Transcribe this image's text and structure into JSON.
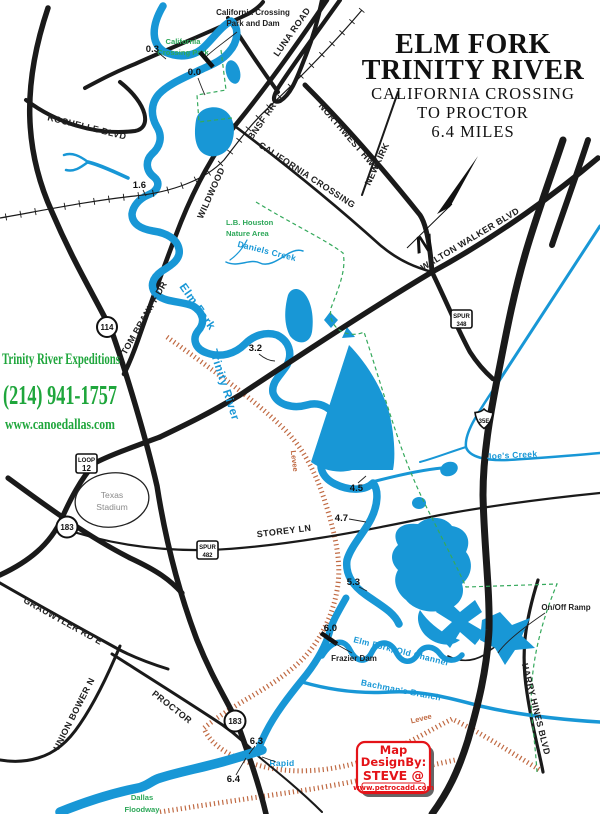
{
  "title": {
    "line1": "ELM FORK",
    "line2": "TRINITY RIVER",
    "line3": "CALIFORNIA CROSSING",
    "line4": "TO PROCTOR",
    "line5": "6.4 MILES"
  },
  "compass_n": "N",
  "advertiser": {
    "name": "Trinity River Expeditions",
    "phone": "(214) 941-1757",
    "website": "www.canoedallas.com",
    "color": "#1FA63C"
  },
  "credit": {
    "line1": "Map",
    "line2": "DesignBy:",
    "line3": "STEVE @",
    "line4": "www.petrocadd.com",
    "color": "#E41318"
  },
  "road_labels": {
    "rochelle": "ROCHELLE BLVD",
    "luna": "LUNA ROAD",
    "northwest": "NORTHWEST HWY",
    "newkirk": "NEWKIRK",
    "california_crossing": "CALIFORNIA CROSSING",
    "wildwood": "WILDWOOD",
    "tom_braniff": "TOM BRANIFF DR",
    "walton_walker": "WALTON WALKER BLVD",
    "storey": "STOREY LN",
    "grauwyler": "GRAUWYLER RD E",
    "union_bower": "UNION BOWER N",
    "proctor": "PROCTOR",
    "harry_hines": "HARRY HINES BLVD"
  },
  "rail_label": "BNSF RR",
  "shields": {
    "hwy114": "114",
    "hwy183": "183",
    "loop12": [
      "LOOP",
      "12"
    ],
    "spur348": [
      "SPUR",
      "348"
    ],
    "spur482": [
      "SPUR",
      "482"
    ],
    "i35e": "35E"
  },
  "water_labels": {
    "elm_fork_1": "Elm Fork",
    "elm_fork_2": "Trinity River",
    "daniels": "Daniels Creek",
    "joes": "Joe's Creek",
    "old_channel": "Elm Fork, Old Channel",
    "bachmans": "Bachman's Branch",
    "rapid": "Rapid"
  },
  "area_labels": {
    "park_1": "California",
    "park_2": "Crossing Park",
    "lb_1": "L.B. Houston",
    "lb_2": "Nature Area",
    "stadium_1": "Texas",
    "stadium_2": "Stadium",
    "floodway_1": "Dallas",
    "floodway_2": "Floodway"
  },
  "levee_labels": {
    "left": "Levee",
    "bottom": "Levee"
  },
  "poi_labels": {
    "park_dam_1": "California Crossing",
    "park_dam_2": "Park and Dam",
    "frazier_dam": "Frazier Dam",
    "on_off_ramp": "On/Off Ramp"
  },
  "mile_markers": [
    "0.3",
    "0.0",
    "1.6",
    "3.2",
    "4.5",
    "4.7",
    "5.3",
    "6.0",
    "6.3",
    "6.4"
  ],
  "colors": {
    "water": "#1897D6",
    "park_green": "#2EA85A",
    "boundary_green": "#35A95C",
    "levee_orange": "#C06A43",
    "credit_red": "#E41318",
    "ad_green": "#1FA63C",
    "road_black": "#1A1A1A"
  }
}
